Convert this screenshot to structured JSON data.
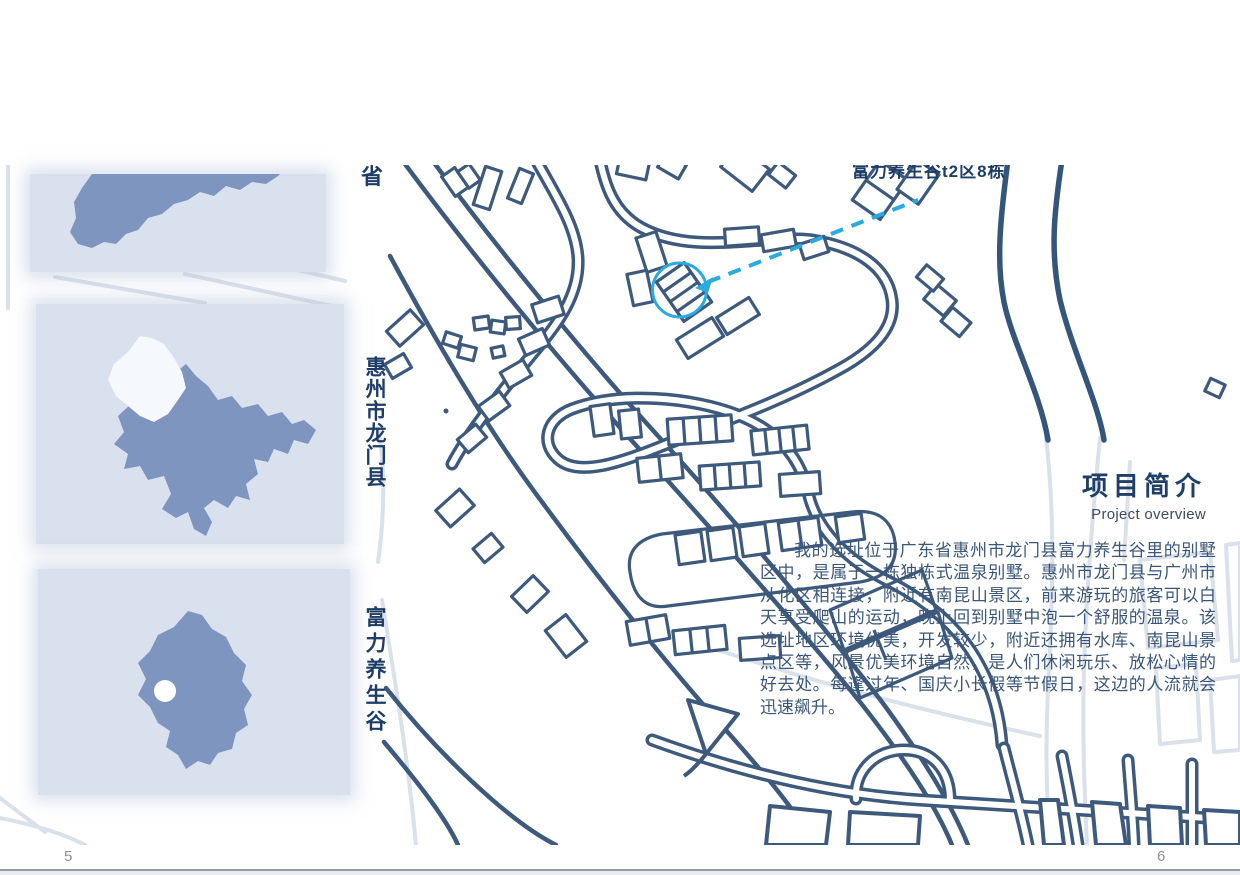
{
  "map": {
    "site_callout": "富力养生谷t2区8栋",
    "clipped_char": "省",
    "accent_color": "#29abe2",
    "line_color": "#3d5a7d",
    "faded_line_color": "#dae1ea"
  },
  "sidebar": {
    "panels": [
      {
        "name": "province-map-thumbnail"
      },
      {
        "name": "city-map-thumbnail"
      },
      {
        "name": "county-map-thumbnail"
      }
    ],
    "panel_bg": "#d9e1ee",
    "shape_color": "#7e95c0",
    "highlight_color": "#f5f8fc",
    "labels": [
      {
        "text": "惠州市龙门县"
      },
      {
        "text": "富力养生谷"
      }
    ]
  },
  "overview": {
    "title": "项目简介",
    "subtitle": "Project overview",
    "body": "我的选址位于广东省惠州市龙门县富力养生谷里的别墅区中，是属于一栋独栋式温泉别墅。惠州市龙门县与广州市从化区相连接，附近有南昆山景区，前来游玩的旅客可以白天享受爬山的运动，晚上回到别墅中泡一个舒服的温泉。该选址地区环境优美，开发较少，附近还拥有水库、南昆山景点区等，风景优美环境自然，是人们休闲玩乐、放松心情的好去处。每逢过年、国庆小长假等节假日，这边的人流就会迅速飙升。"
  },
  "footer": {
    "page_left": "5",
    "page_right": "6"
  }
}
